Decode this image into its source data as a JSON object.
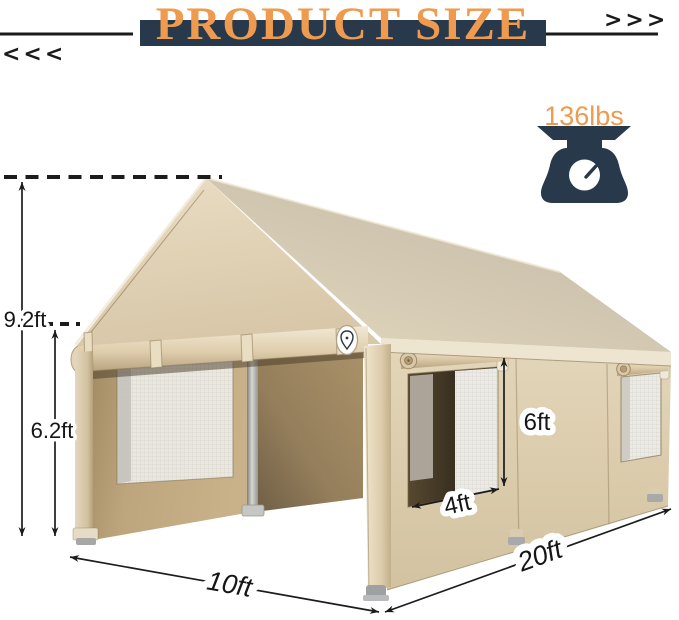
{
  "header": {
    "title": "PRODUCT SIZE",
    "left_arrows": "<<<",
    "right_arrows": ">>>"
  },
  "weight": {
    "label": "136lbs",
    "icon": "weight-scale-icon"
  },
  "dimensions": {
    "peak_height": "9.2ft",
    "side_height": "6.2ft",
    "window_height": "6ft",
    "window_width": "4ft",
    "front_width": "10ft",
    "side_length": "20ft"
  },
  "icons": {
    "weight": "scale-icon",
    "badge": "brand-badge-icon",
    "left_arrows": "chevrons-left-icon",
    "right_arrows": "chevrons-right-icon"
  },
  "colors": {
    "accent_orange": "#EE9A4F",
    "navy": "#27394B",
    "line_black": "#1C1C1C",
    "tent_gable": "#E2D4B8",
    "tent_roof": "#CDC3AE",
    "tent_wall": "#DACBAC",
    "interior_tan": "#B0976E",
    "mesh_white": "#ECEAE5"
  }
}
